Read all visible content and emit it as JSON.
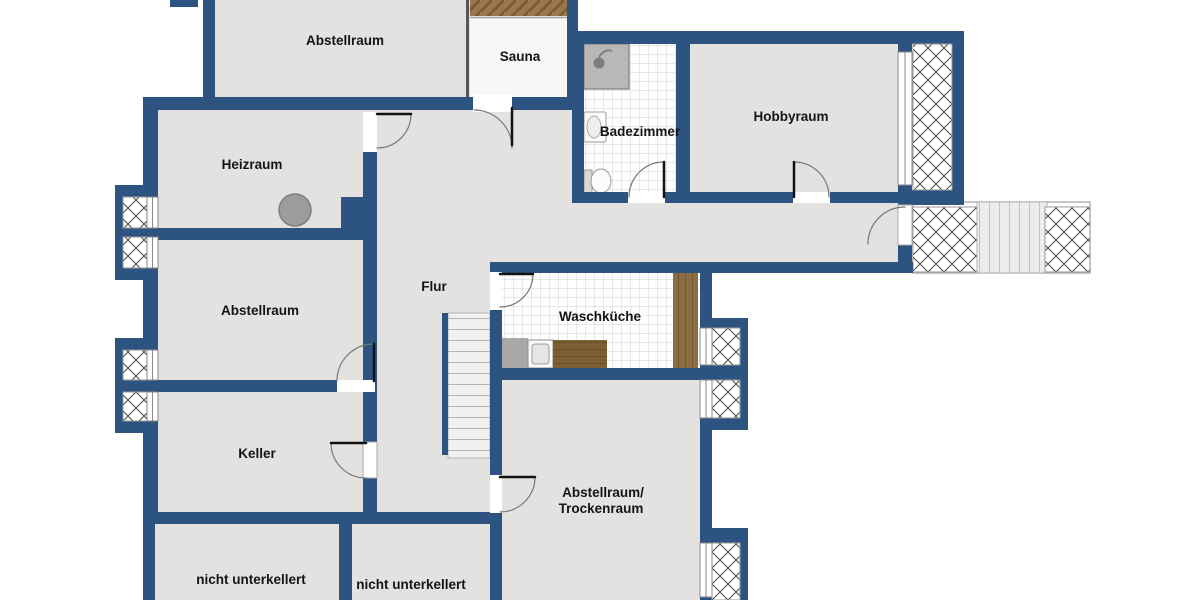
{
  "plan": {
    "type": "basement-floor-plan",
    "rooms": [
      {
        "id": "abstellraum-top",
        "label": "Abstellraum"
      },
      {
        "id": "sauna",
        "label": "Sauna"
      },
      {
        "id": "badezimmer",
        "label": "Badezimmer"
      },
      {
        "id": "hobbyraum",
        "label": "Hobbyraum"
      },
      {
        "id": "heizraum",
        "label": "Heizraum"
      },
      {
        "id": "abstellraum-left",
        "label": "Abstellraum"
      },
      {
        "id": "flur",
        "label": "Flur"
      },
      {
        "id": "waschkueche",
        "label": "Waschküche"
      },
      {
        "id": "keller",
        "label": "Keller"
      },
      {
        "id": "abstellraum-trockenraum",
        "label": "Abstellraum/",
        "label2": "Trockenraum"
      },
      {
        "id": "nicht-unterkellert-links",
        "label": "nicht unterkellert"
      },
      {
        "id": "nicht-unterkellert-mitte",
        "label": "nicht unterkellert"
      }
    ],
    "fixtures": [
      "sauna-bench",
      "shower",
      "sink",
      "toilet",
      "boiler",
      "washing-machine",
      "laundry-counter",
      "wood-cabinet",
      "interior-stairs",
      "exterior-stairs",
      "lightwell-windows"
    ],
    "colors": {
      "wall": "#2d5381",
      "floor": "#e3e2e0",
      "sauna_floor": "#f7f7f5",
      "wood_light": "#9a784c",
      "wood_mid": "#8b6d44",
      "wood_dark": "#7d5f35",
      "appliance_gray": "#a8a8a6",
      "boiler_gray": "#9c9c9a",
      "label_text": "#141414"
    }
  }
}
